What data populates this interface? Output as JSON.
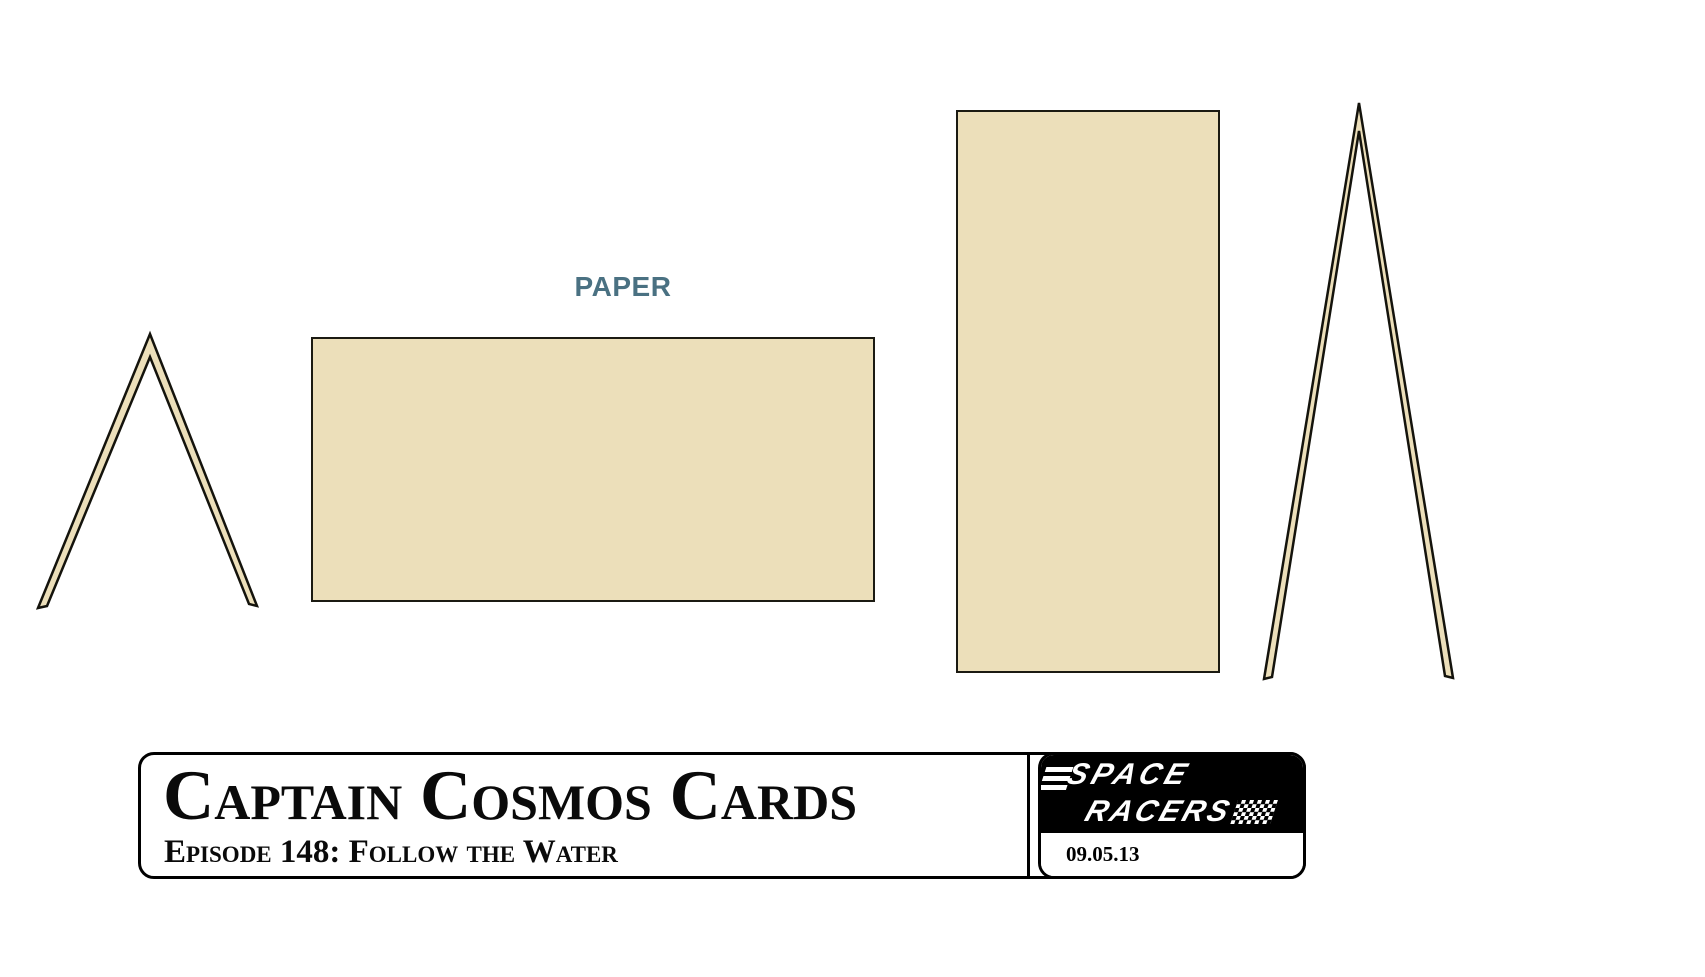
{
  "canvas": {
    "background": "#ffffff"
  },
  "paper_label": {
    "text": "PAPER",
    "color": "#4A7182"
  },
  "sheets": {
    "fill": "#ECDFBA",
    "outline": "#1b1a12",
    "items": [
      {
        "name": "folded-card-tent-left"
      },
      {
        "name": "paper-sheet-landscape"
      },
      {
        "name": "paper-sheet-portrait"
      },
      {
        "name": "folded-card-tent-right"
      }
    ]
  },
  "title_block": {
    "title": "Captain Cosmos Cards",
    "subtitle": "Episode 148: Follow the Water",
    "date": "09.05.13"
  },
  "logo": {
    "line1": "SPACE",
    "line2": "RACERS",
    "bg": "#000000",
    "text_color": "#ffffff",
    "flag_icon": "checkered-flag-icon"
  }
}
